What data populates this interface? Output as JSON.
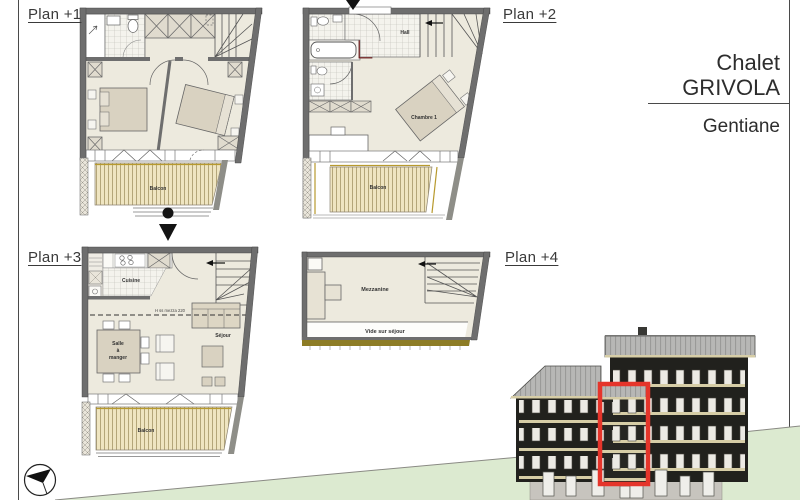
{
  "sheet": {
    "title_line1": "Chalet",
    "title_line2": "GRIVOLA",
    "project": "Gentiane"
  },
  "plans": {
    "plan1": {
      "label": "Plan +1",
      "balcon": "Balcon"
    },
    "plan2": {
      "label": "Plan +2",
      "hall": "Hall",
      "chambre": "Chambre 1",
      "balcon": "Balcon"
    },
    "plan3": {
      "label": "Plan +3",
      "cuisine": "Cuisine",
      "salle_1": "Salle",
      "salle_2": "à",
      "salle_3": "manger",
      "sejour": "Séjour",
      "mezz_note": "H ss mezza 220",
      "balcon": "Balcon"
    },
    "plan4": {
      "label": "Plan +4",
      "mezzanine": "Mezzanine",
      "vide": "Vide sur séjour"
    }
  },
  "colors": {
    "highlight_red": "#E5352B",
    "shaft_red": "#C92020",
    "terrain_green": "#DCEAD0",
    "wall_gray": "#6E6E6E",
    "floor_cream": "#EDEADE",
    "balcony_tan": "#EFE5C1",
    "balcony_edge_khaki": "#B89A2E",
    "roof_gray": "#B7B7B5",
    "facade_dark": "#21211D",
    "rail_cream": "#D6CDA6"
  }
}
